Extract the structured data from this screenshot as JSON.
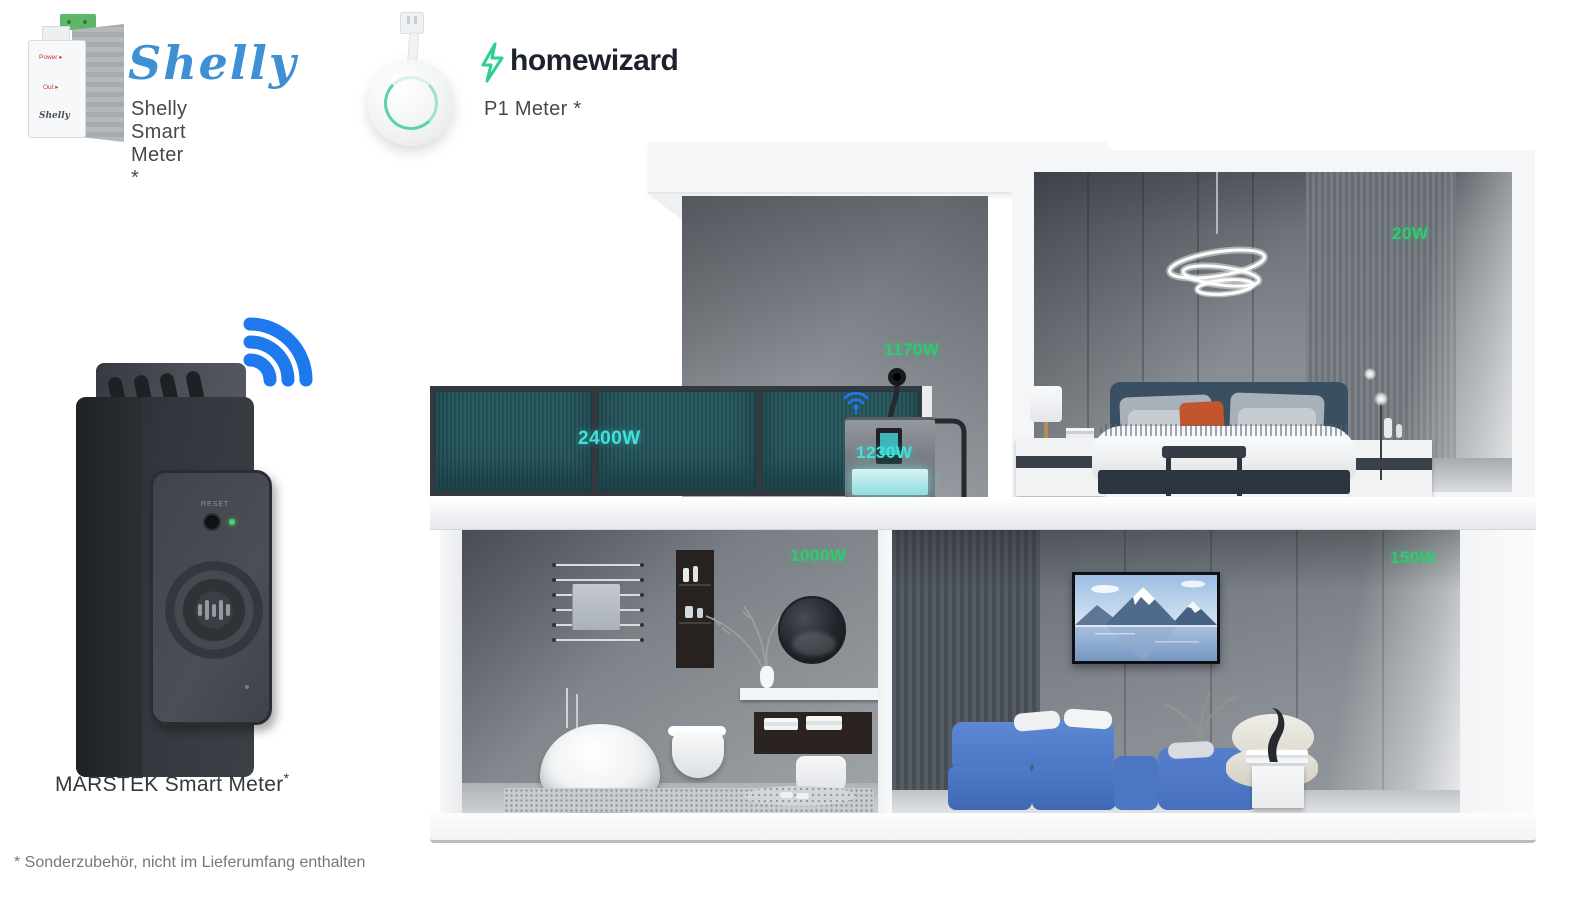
{
  "products": {
    "shelly": {
      "logo_text": "Shelly",
      "label": "Shelly Smart Meter *",
      "device": {
        "power": "Power ▸",
        "out": "Out ▸",
        "brand": "Shelly"
      }
    },
    "homewizard": {
      "logo_text": "homewizard",
      "label": "P1 Meter *"
    },
    "marstek": {
      "label": "MARSTEK Smart Meter",
      "asterisk": "*",
      "device_reset": "RESET"
    }
  },
  "footnote": "* Sonderzubehör, nicht im Lieferumfang enthalten",
  "house": {
    "power_labels": {
      "solar": "2400W",
      "wall_plug": "1170W",
      "battery": "1230W",
      "bedroom_light": "20W",
      "bathroom": "1000W",
      "living_room": "150W"
    },
    "colors": {
      "label_green": "#2ecc71",
      "label_cyan": "#3fe3dc",
      "wifi_blue": "#1e78ee",
      "solar_teal": "#2c5b61",
      "sofa_blue": "#4d7ac8",
      "shelly_blue": "#3e8fd4",
      "homewizard_green": "#2bd18d"
    }
  }
}
